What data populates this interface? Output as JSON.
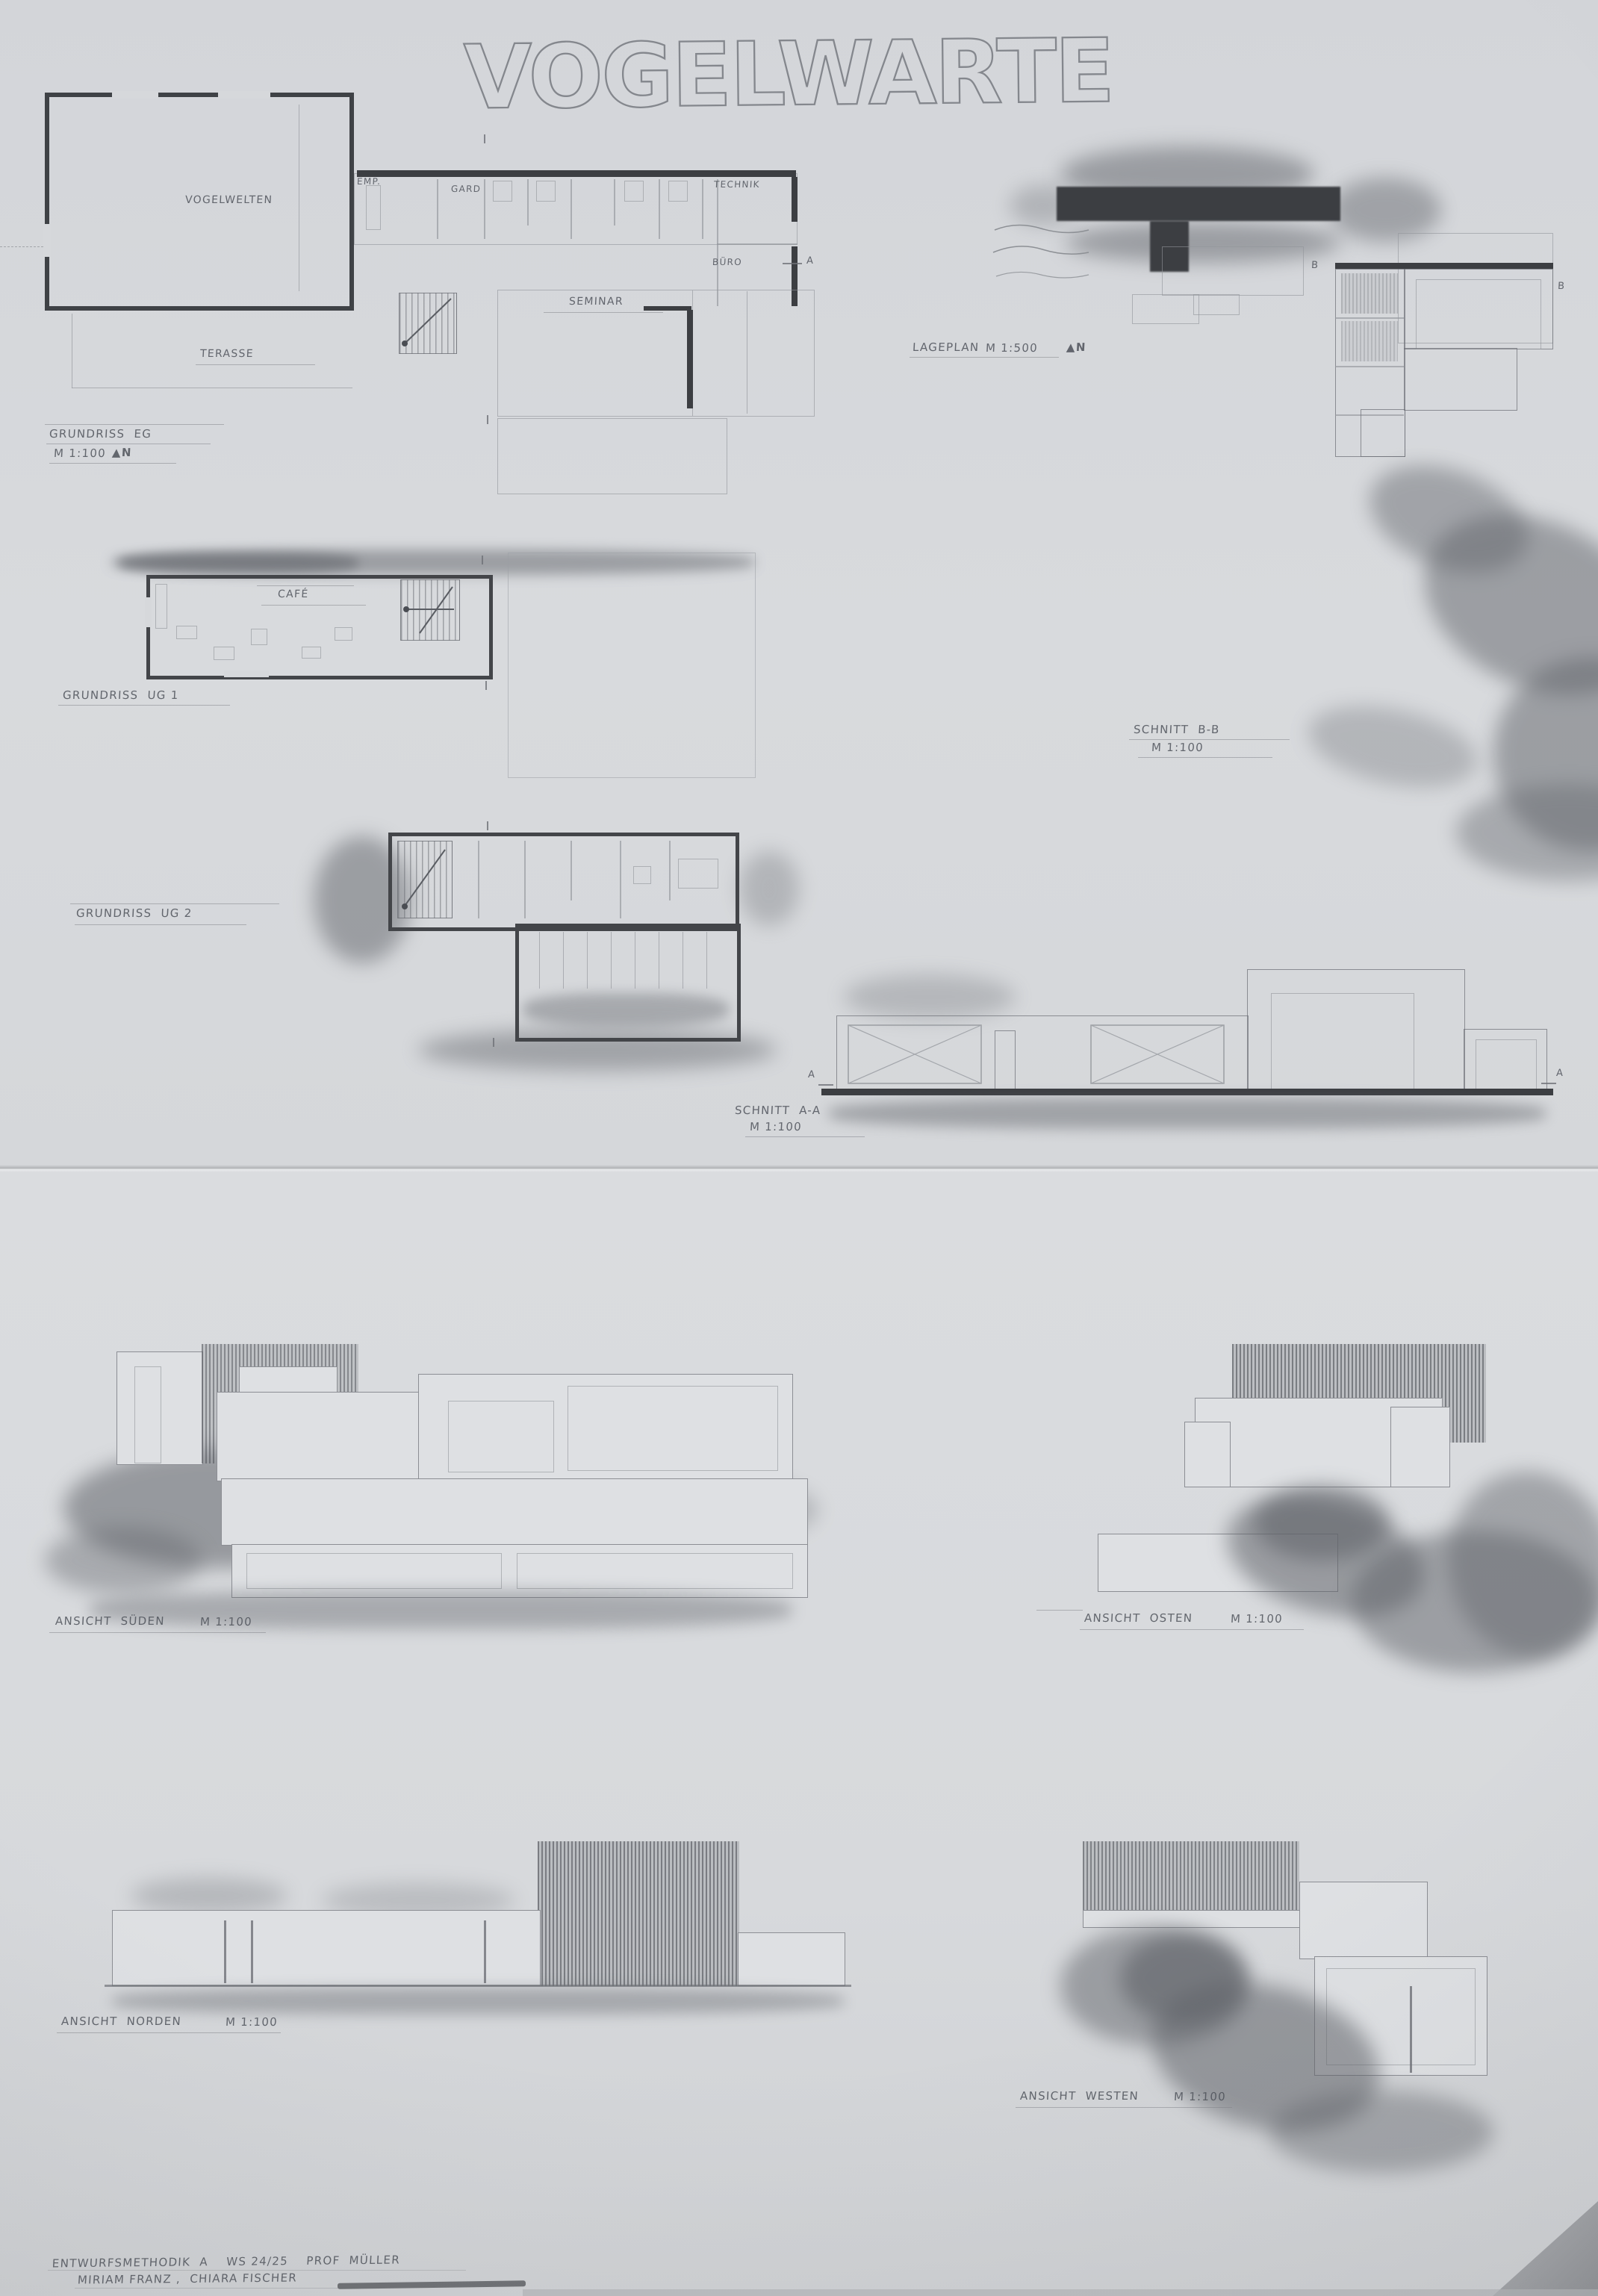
{
  "title": "VOGELWARTE",
  "top_sheet": {
    "grundriss_eg": {
      "name": "GRUNDRISS  EG",
      "scale": "M 1:100",
      "north": "▲N",
      "rooms": {
        "vogelwelten": "VOGELWELTEN",
        "empfang": "EMP.",
        "garderobe": "GARD",
        "technik": "TECHNIK",
        "buero": "BÜRO",
        "seminar": "SEMINAR",
        "terasse": "TERASSE"
      },
      "marker_a": "A"
    },
    "lageplan": {
      "name": "LAGEPLAN",
      "scale": "M 1:500",
      "north": "▲N"
    },
    "grundriss_ug1": {
      "name": "GRUNDRISS  UG 1",
      "rooms": {
        "cafe": "CAFÉ"
      }
    },
    "schnitt_bb": {
      "name": "SCHNITT  B-B",
      "scale": "M 1:100",
      "marker_left": "B",
      "marker_right": "B"
    },
    "grundriss_ug2": {
      "name": "GRUNDRISS  UG 2"
    },
    "schnitt_aa": {
      "name": "SCHNITT  A-A",
      "scale": "M 1:100",
      "marker_left": "A",
      "marker_right": "A"
    }
  },
  "bottom_sheet": {
    "ansicht_sueden": {
      "name": "ANSICHT  SÜDEN",
      "scale": "M 1:100"
    },
    "ansicht_osten": {
      "name": "ANSICHT  OSTEN",
      "scale": "M 1:100"
    },
    "ansicht_norden": {
      "name": "ANSICHT  NORDEN",
      "scale": "M 1:100"
    },
    "ansicht_westen": {
      "name": "ANSICHT  WESTEN",
      "scale": "M 1:100"
    },
    "credits": {
      "line1": "ENTWURFSMETHODIK  A    WS 24/25    PROF  MÜLLER",
      "line2": "MIRIAM FRANZ ,  CHIARA FISCHER"
    }
  },
  "colors": {
    "paper_top": "#d6d8db",
    "paper_bottom": "#dadcdf",
    "pencil_dark": "#3f4246",
    "pencil_mid": "#6e7177",
    "pencil_light": "#9a9da2",
    "wash_gray": "#61646a"
  }
}
